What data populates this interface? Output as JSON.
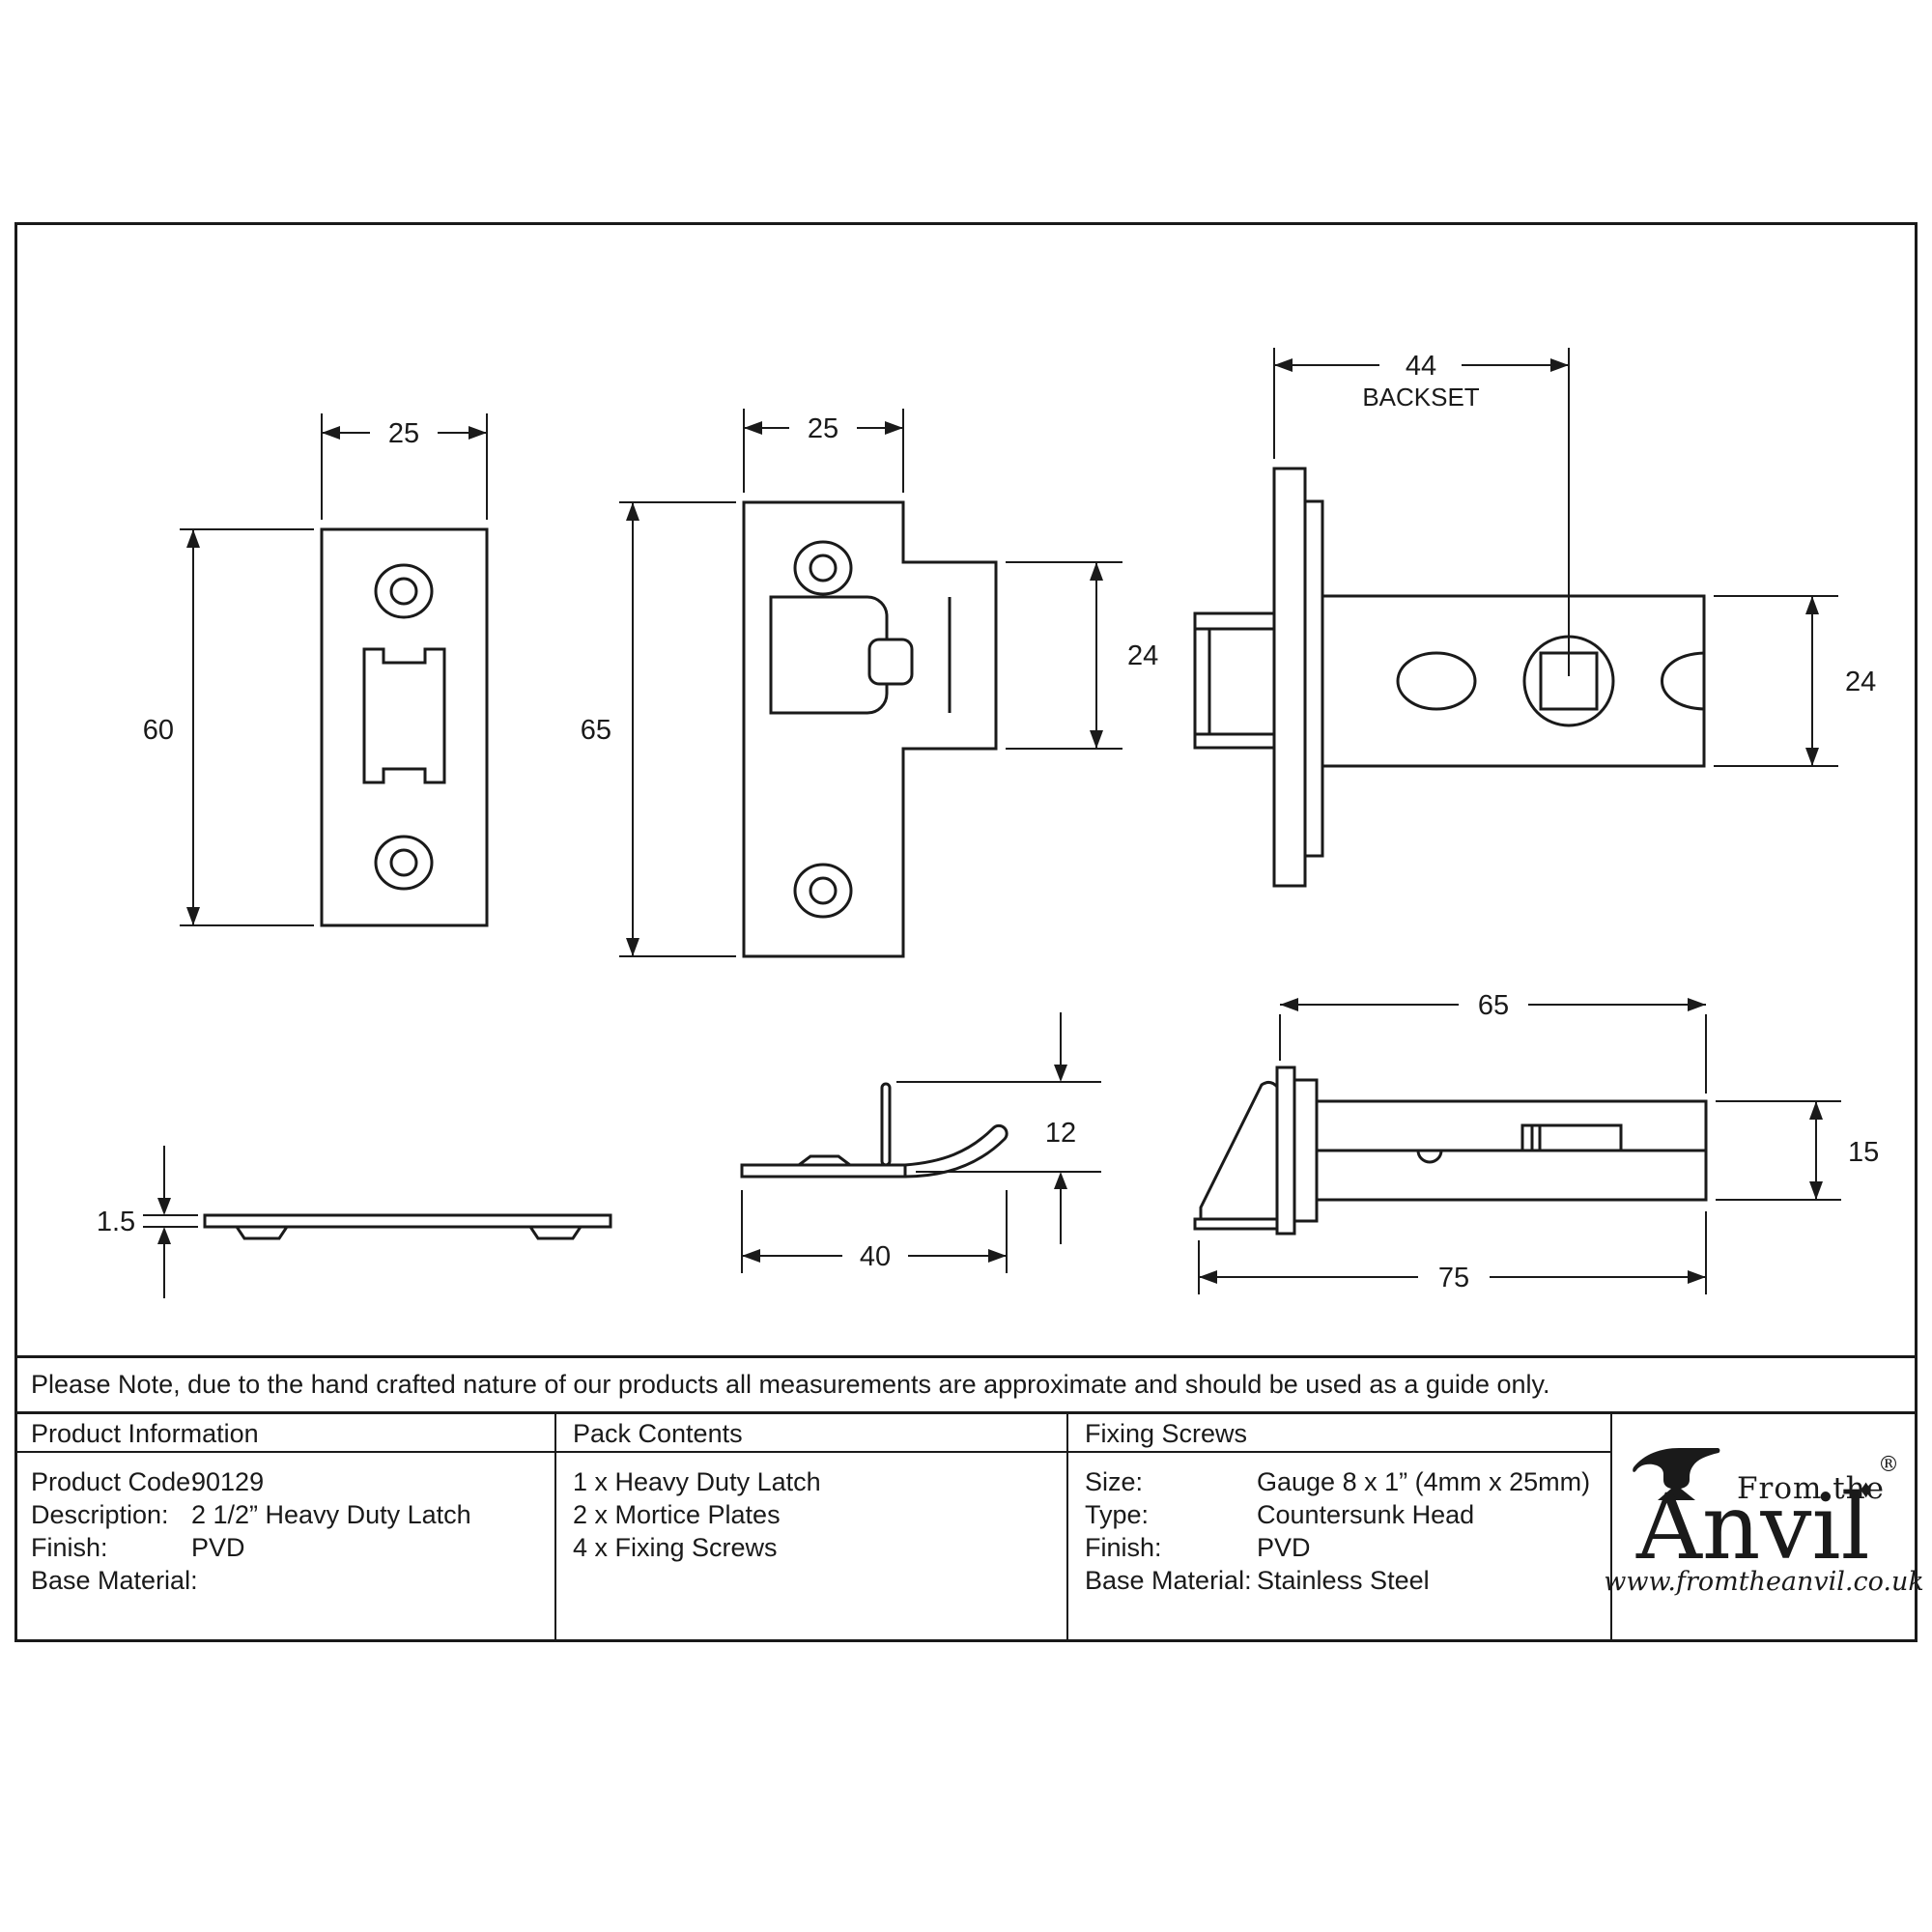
{
  "note": "Please Note, due to the hand crafted nature of our products all measurements are approximate and should be used as a guide only.",
  "table": {
    "product_information": {
      "title": "Product Information",
      "rows": [
        {
          "label": "Product Code:",
          "value": "90129"
        },
        {
          "label": "Description:",
          "value": "2 1/2” Heavy Duty Latch"
        },
        {
          "label": "Finish:",
          "value": "PVD"
        },
        {
          "label": "Base Material:",
          "value": ""
        }
      ]
    },
    "pack_contents": {
      "title": "Pack Contents",
      "items": [
        "1 x Heavy Duty Latch",
        "2 x Mortice Plates",
        "4 x Fixing Screws"
      ]
    },
    "fixing_screws": {
      "title": "Fixing Screws",
      "rows": [
        {
          "label": "Size:",
          "value": "Gauge 8 x 1” (4mm x 25mm)"
        },
        {
          "label": "Type:",
          "value": "Countersunk Head"
        },
        {
          "label": "Finish:",
          "value": "PVD"
        },
        {
          "label": "Base Material:",
          "value": "Stainless Steel"
        }
      ]
    }
  },
  "logo": {
    "from_the": "From the",
    "diamond": "♦",
    "wordmark": "Anvil",
    "registered": "®",
    "url": "www.fromtheanvil.co.uk"
  },
  "drawings": {
    "mortice_plate_front": {
      "width_mm": "25",
      "height_mm": "60"
    },
    "strike_plate_front": {
      "width_mm": "25",
      "height_mm": "65",
      "wing_mm": "24"
    },
    "latch_side": {
      "backset_mm": "44",
      "backset_label": "BACKSET",
      "case_height_mm": "24"
    },
    "plate_edge": {
      "thickness_mm": "1.5"
    },
    "strike_edge": {
      "width_mm": "40",
      "lug_mm": "12"
    },
    "latch_top": {
      "case_mm": "65",
      "overall_mm": "75",
      "barrel_mm": "15"
    }
  },
  "colors": {
    "line": "#1a1a1a",
    "background": "#ffffff"
  }
}
